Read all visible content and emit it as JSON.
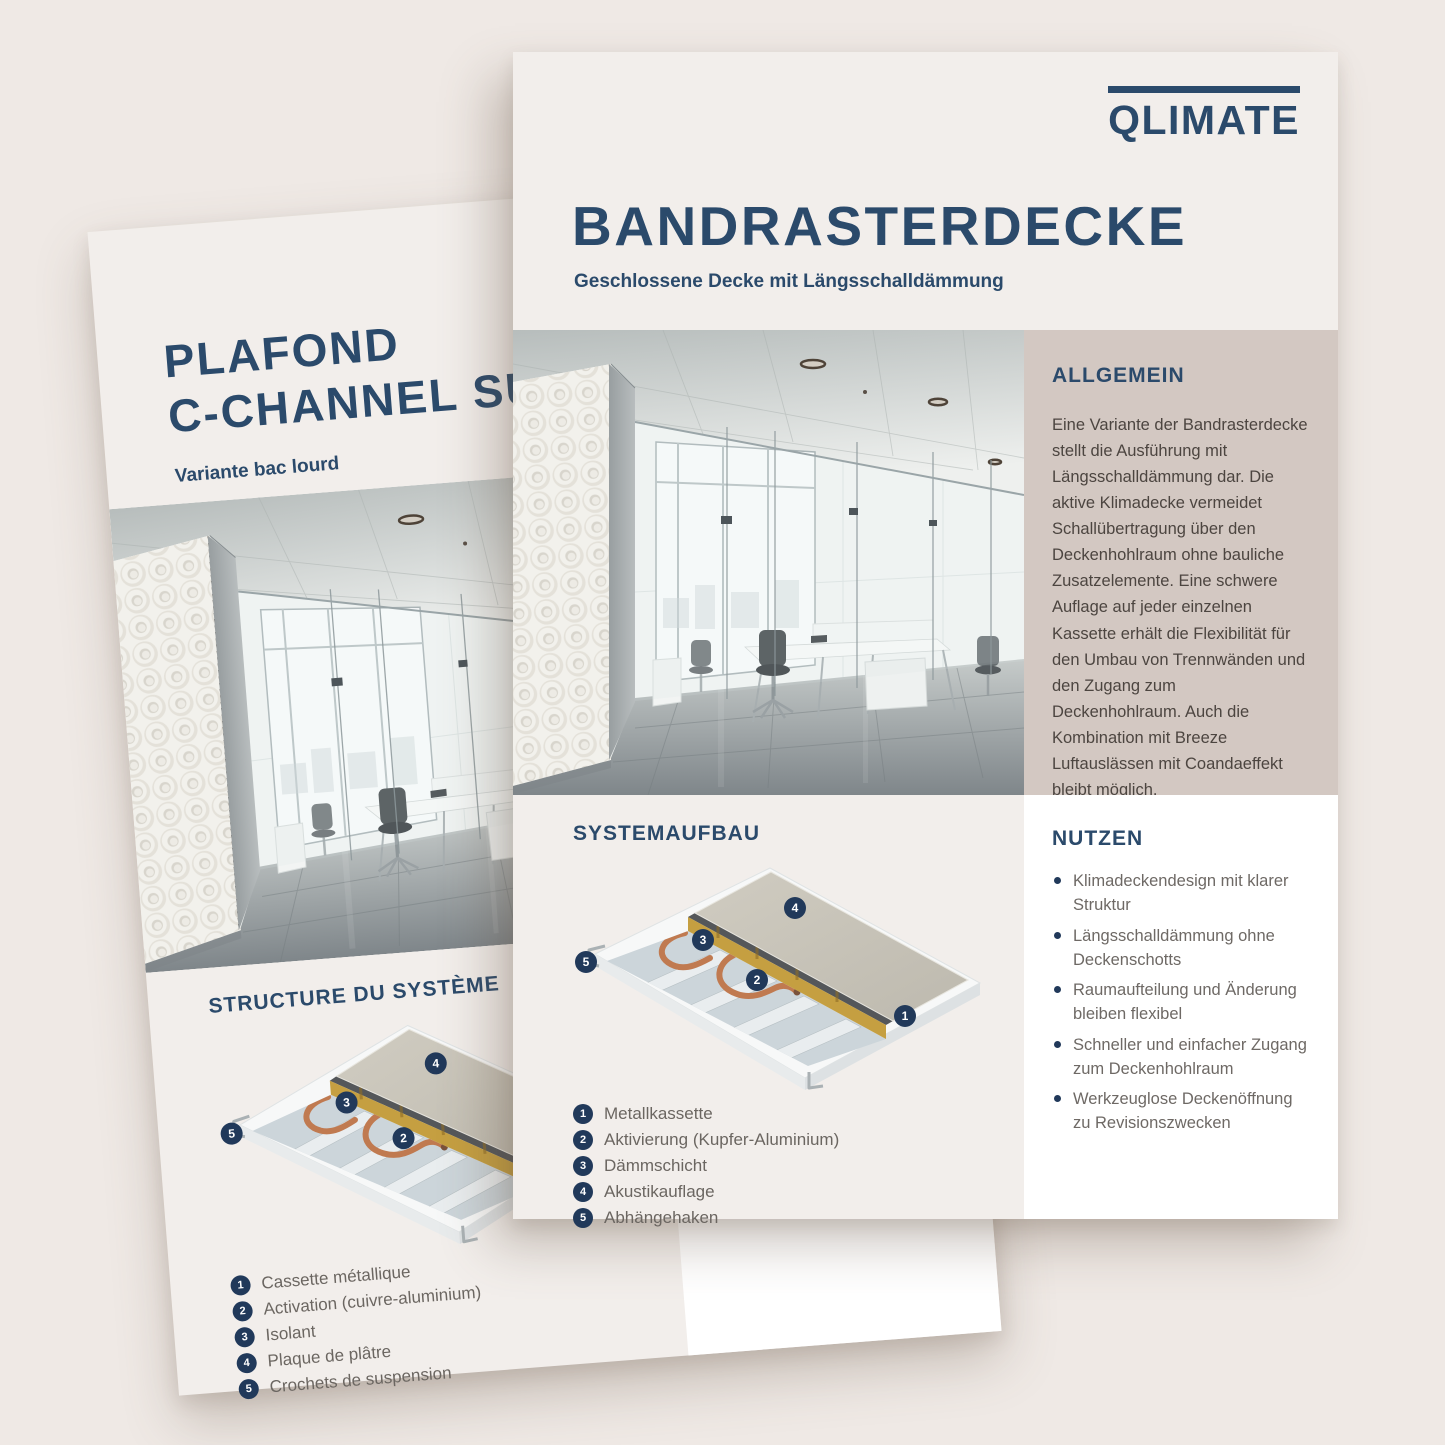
{
  "front_page": {
    "logo_text": "QLIMATE",
    "title": "BANDRASTERDECKE",
    "subtitle": "Geschlossene Decke mit Längsschalldämmung",
    "allgemein": {
      "heading": "ALLGEMEIN",
      "body": "Eine Variante der Bandrasterdecke stellt die Ausführung mit Längsschalldämmung dar. Die aktive Klimadecke vermeidet Schallübertragung über den Deckenhohlraum ohne bauliche Zusatzelemente. Eine schwere Auflage auf jeder einzelnen Kassette erhält die Flexibilität für den Umbau von Trennwänden und den Zugang zum Deckenhohlraum. Auch die Kombination mit Breeze Luftauslässen mit Coandaeffekt bleibt möglich."
    },
    "systemaufbau": {
      "heading": "SYSTEMAUFBAU",
      "items": [
        {
          "num": "1",
          "label": "Metallkassette"
        },
        {
          "num": "2",
          "label": "Aktivierung (Kupfer-Aluminium)"
        },
        {
          "num": "3",
          "label": "Dämmschicht"
        },
        {
          "num": "4",
          "label": "Akustikauflage"
        },
        {
          "num": "5",
          "label": "Abhängehaken"
        }
      ]
    },
    "nutzen": {
      "heading": "NUTZEN",
      "items": [
        "Klimadeckendesign mit klarer Struktur",
        "Längsschalldämmung ohne Deckenschotts",
        "Raumaufteilung und Änderung bleiben flexibel",
        "Schneller und einfacher Zugang zum Deckenhohlraum",
        "Werkzeuglose Deckenöffnung zu Revisionszwecken"
      ]
    }
  },
  "back_page": {
    "title_line1": "PLAFOND",
    "title_line2": "C-CHANNEL SU",
    "subtitle": "Variante bac lourd",
    "structure": {
      "heading": "STRUCTURE DU SYSTÈME",
      "items": [
        {
          "num": "1",
          "label": "Cassette métallique"
        },
        {
          "num": "2",
          "label": "Activation (cuivre-aluminium)"
        },
        {
          "num": "3",
          "label": "Isolant"
        },
        {
          "num": "4",
          "label": "Plaque de plâtre"
        },
        {
          "num": "5",
          "label": "Crochets de suspension"
        }
      ]
    }
  },
  "diagram": {
    "markers": [
      "1",
      "2",
      "3",
      "4",
      "5"
    ]
  },
  "colors": {
    "navy": "#2b4a6b",
    "badge_navy": "#21395a",
    "beige_block": "#d3c8c2",
    "page_bg": "#f2eeeb",
    "canvas_bg": "#efe9e5",
    "white_panel": "#ffffff"
  }
}
